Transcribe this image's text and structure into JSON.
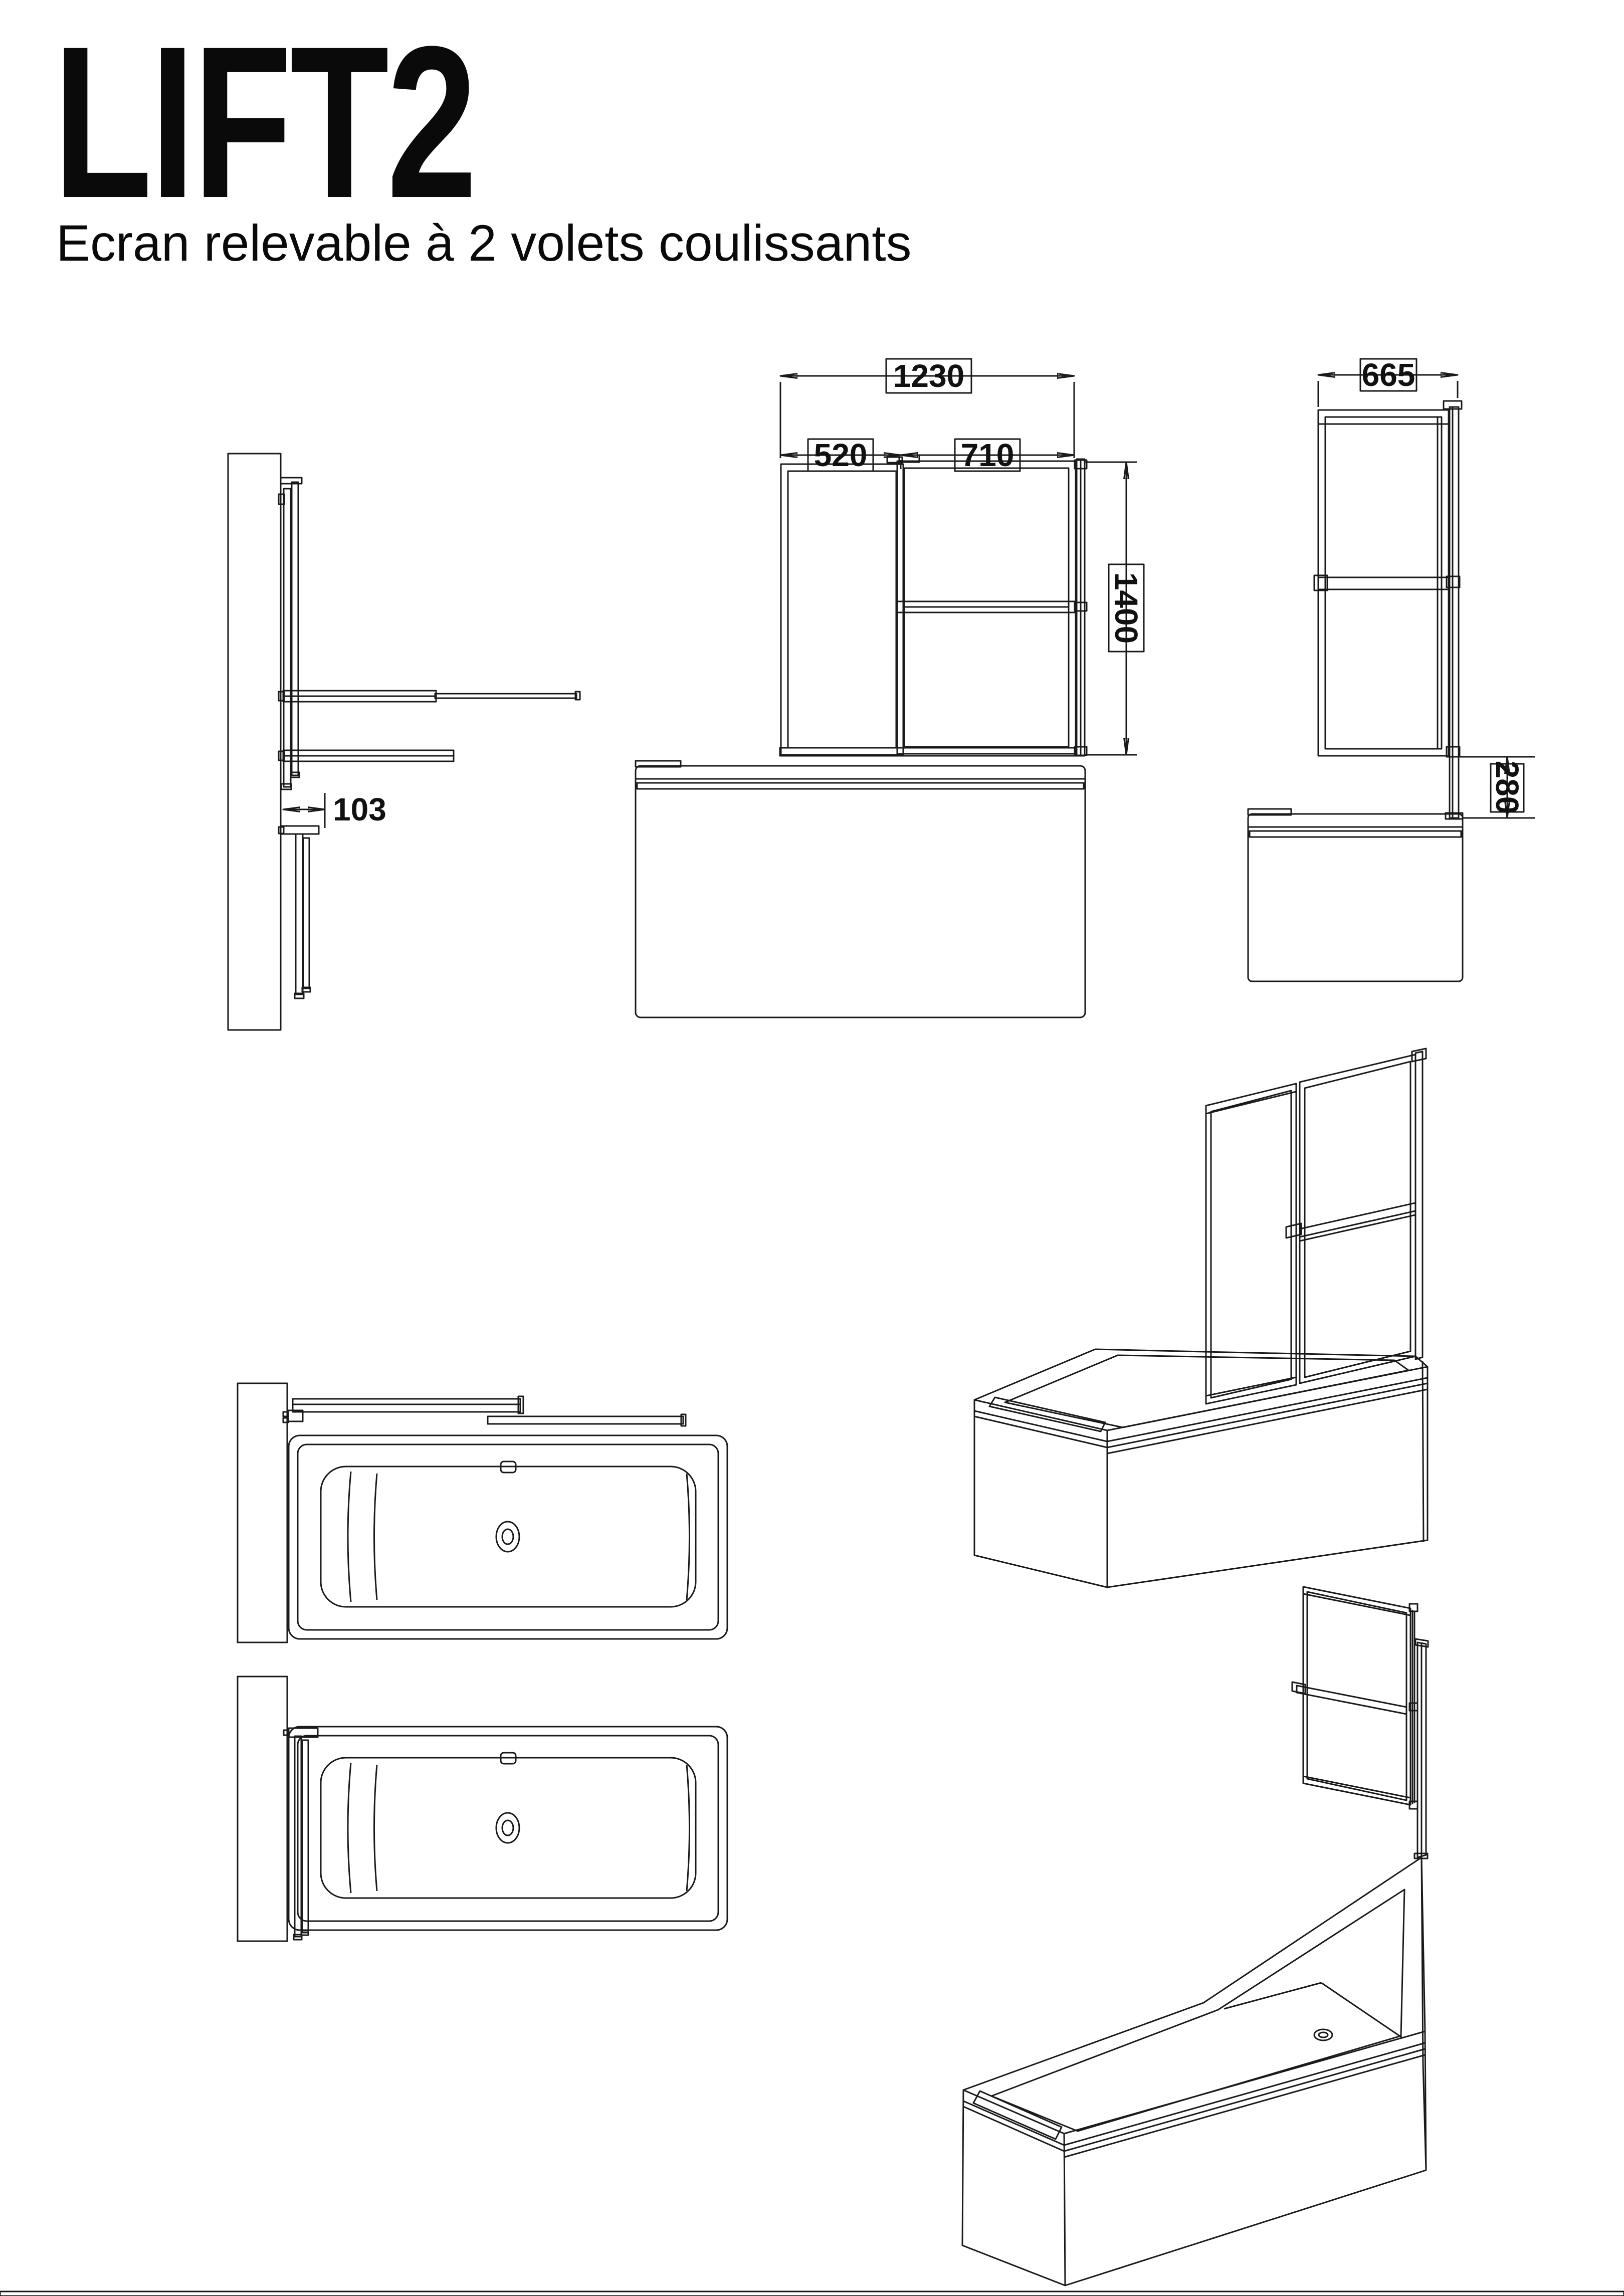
{
  "title": "LIFT2",
  "subtitle": "Ecran relevable à 2 volets coulissants",
  "dims": {
    "total_width": "1230",
    "left_panel_width": "520",
    "right_panel_width": "710",
    "screen_height": "1400",
    "screen_depth": "665",
    "lift_clearance": "280",
    "wall_offset": "103"
  },
  "colors": {
    "line": "#1a1a1a",
    "rim_gray": "#a8a8a8",
    "pad_gray": "#8f8f8f",
    "background": "#ffffff"
  }
}
